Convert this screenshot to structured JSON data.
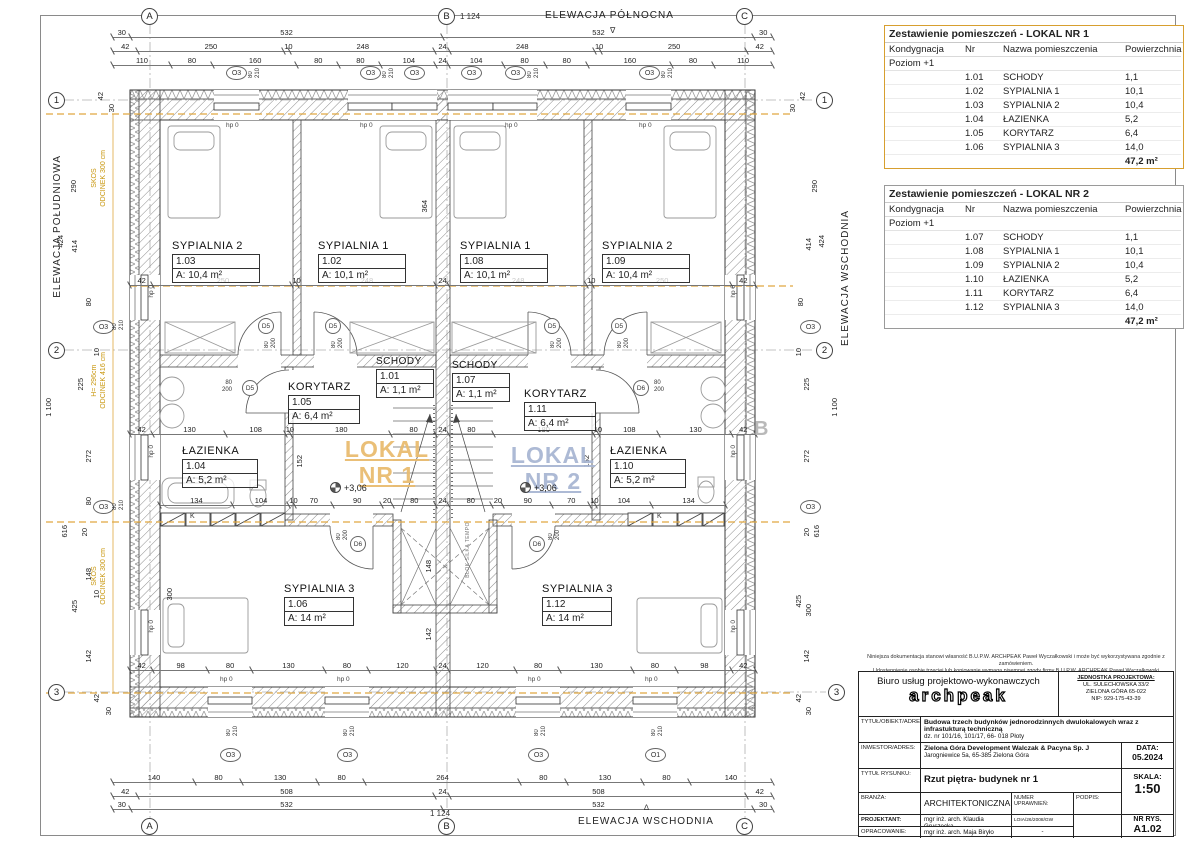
{
  "plan": {
    "title_north": "ELEWACJA PÓŁNOCNA",
    "title_south": "ELEWACJA POŁUDNIOWA",
    "title_east": "ELEWACJA WSCHODNIA",
    "title_bottom": "ELEWACJA WSCHODNIA",
    "overall_w": "1 124",
    "overall_h": "1 100",
    "marker_down": "∇",
    "marker_up": "∆",
    "grid_cols": [
      "A",
      "B",
      "C"
    ],
    "grid_rows": [
      "1",
      "2",
      "3"
    ],
    "rooms": {
      "r103": {
        "name": "SYPIALNIA 2",
        "nr": "1.03",
        "area": "A: 10,4 m²"
      },
      "r102": {
        "name": "SYPIALNIA 1",
        "nr": "1.02",
        "area": "A: 10,1 m²"
      },
      "r108": {
        "name": "SYPIALNIA 1",
        "nr": "1.08",
        "area": "A: 10,1 m²"
      },
      "r109": {
        "name": "SYPIALNIA 2",
        "nr": "1.09",
        "area": "A: 10,4 m²"
      },
      "r105": {
        "name": "KORYTARZ",
        "nr": "1.05",
        "area": "A: 6,4 m²"
      },
      "r101": {
        "name": "SCHODY",
        "nr": "1.01",
        "area": "A: 1,1 m²"
      },
      "r107": {
        "name": "SCHODY",
        "nr": "1.07",
        "area": "A: 1,1 m²"
      },
      "r111": {
        "name": "KORYTARZ",
        "nr": "1.11",
        "area": "A: 6,4 m²"
      },
      "r104": {
        "name": "ŁAZIENKA",
        "nr": "1.04",
        "area": "A: 5,2 m²"
      },
      "r110": {
        "name": "ŁAZIENKA",
        "nr": "1.10",
        "area": "A: 5,2 m²"
      },
      "r106": {
        "name": "SYPIALNIA 3",
        "nr": "1.06",
        "area": "A: 14 m²"
      },
      "r112": {
        "name": "SYPIALNIA 3",
        "nr": "1.12",
        "area": "A: 14 m²"
      }
    },
    "watermarks": {
      "lokal1": "LOKAL\nNR 1",
      "lokal2": "LOKAL\nNR 2",
      "level": "+3,06",
      "section_b": "B",
      "wall_note": "BLOK SILKA TEMPO",
      "k_box": "K"
    },
    "dims": {
      "top1": [
        "30",
        "532",
        "532",
        "30"
      ],
      "top2": [
        "42",
        "250",
        "10",
        "248",
        "24",
        "248",
        "10",
        "250",
        "42"
      ],
      "top3": [
        "110",
        "80",
        "160",
        "80",
        "80",
        "104",
        "24",
        "104",
        "80",
        "80",
        "160",
        "80",
        "110"
      ],
      "bed": [
        "42",
        "250",
        "10",
        "248",
        "24",
        "248",
        "10",
        "250",
        "42"
      ],
      "mid": [
        "42",
        "130",
        "108",
        "10",
        "180",
        "80",
        "24",
        "80",
        "180",
        "10",
        "108",
        "130",
        "42"
      ],
      "bath": [
        "134",
        "104",
        "10",
        "70",
        "90",
        "20",
        "80",
        "24",
        "80",
        "20",
        "90",
        "70",
        "10",
        "104",
        "134"
      ],
      "low": [
        "42",
        "98",
        "80",
        "130",
        "80",
        "120",
        "24",
        "120",
        "80",
        "130",
        "80",
        "98",
        "42"
      ],
      "bottom1": [
        "140",
        "80",
        "130",
        "80",
        "264",
        "80",
        "130",
        "80",
        "140"
      ],
      "bottom2": [
        "42",
        "508",
        "24",
        "508",
        "42"
      ],
      "bottom3": [
        "30",
        "532",
        "532",
        "30"
      ],
      "left": [
        "42",
        "30",
        "290",
        "424",
        "414",
        "80",
        "10",
        "225",
        "1 100",
        "272",
        "80",
        "616",
        "20",
        "148",
        "425",
        "10",
        "142",
        "42",
        "30"
      ],
      "right": [
        "42",
        "30",
        "290",
        "414",
        "424",
        "80",
        "225",
        "10",
        "272",
        "616",
        "20",
        "425",
        "300",
        "142",
        "42",
        "30",
        "1 100"
      ],
      "v364": "364",
      "v152": "152",
      "v300": "300",
      "v148": "148",
      "v142": "142",
      "hp0": "hp 0"
    },
    "openings": {
      "o3": "O3",
      "o1": "O1",
      "o_size": "80\n210",
      "d5": "D5",
      "d6": "D6",
      "d_size": "80\n200"
    },
    "slopes": {
      "s1": "SKOS\nODCINEK 300 cm",
      "s2": "H= 296cm\nODCINEK 416 cm",
      "s3": "SKOS\nODCINEK 300 cm"
    }
  },
  "tables": [
    {
      "title": "Zestawienie pomieszczeń - LOKAL NR 1",
      "col_kond": "Kondygnacja",
      "col_nr": "Nr",
      "col_nazwa": "Nazwa pomieszczenia",
      "col_pow": "Powierzchnia",
      "level": "Poziom +1",
      "rows": [
        [
          "1.01",
          "SCHODY",
          "1,1"
        ],
        [
          "1.02",
          "SYPIALNIA 1",
          "10,1"
        ],
        [
          "1.03",
          "SYPIALNIA 2",
          "10,4"
        ],
        [
          "1.04",
          "ŁAZIENKA",
          "5,2"
        ],
        [
          "1.05",
          "KORYTARZ",
          "6,4"
        ],
        [
          "1.06",
          "SYPIALNIA 3",
          "14,0"
        ]
      ],
      "total": "47,2 m²"
    },
    {
      "title": "Zestawienie pomieszczeń - LOKAL NR 2",
      "col_kond": "Kondygnacja",
      "col_nr": "Nr",
      "col_nazwa": "Nazwa pomieszczenia",
      "col_pow": "Powierzchnia",
      "level": "Poziom +1",
      "rows": [
        [
          "1.07",
          "SCHODY",
          "1,1"
        ],
        [
          "1.08",
          "SYPIALNIA 1",
          "10,1"
        ],
        [
          "1.09",
          "SYPIALNIA 2",
          "10,4"
        ],
        [
          "1.10",
          "ŁAZIENKA",
          "5,2"
        ],
        [
          "1.11",
          "KORYTARZ",
          "6,4"
        ],
        [
          "1.12",
          "SYPIALNIA 3",
          "14,0"
        ]
      ],
      "total": "47,2 m²"
    }
  ],
  "titleblock": {
    "disclaimer1": "Niniejsza dokumentacja stanowi własność B.U.P.W. ARCHPEAK Paweł Wyczałkowski i może być wykorzystywana zgodnie z zamówieniem.",
    "disclaimer2": "Udostępnienie osobie trzeciej lub kopiowanie wymaga pisemnej zgody firmy B.U.P.W. ARCHPEAK Paweł Wyczałkowski",
    "office_line": "Biuro usług projektowo-wykonawczych",
    "logo": "archpeak",
    "unit_label": "JEDNOSTKA PROJEKTOWA:",
    "unit_addr1": "UL. SULECHOWSKA 33/2",
    "unit_addr2": "ZIELONA GÓRA 65-022",
    "unit_nip": "NIP: 929-175-43-39",
    "obj_label": "TYTUŁ/OBIEKT/ADRES:",
    "obj_value": "Budowa trzech budynków jednorodzinnych dwulokalowych wraz z infrastukturą techniczną",
    "obj_value2": "dz. nr 101/16, 101/17, 66- 018 Płoty",
    "inv_label": "INWESTOR/ADRES:",
    "inv_value": "Zielona Góra Development Walczak & Pacyna Sp. J",
    "inv_value2": "Jarogniewice 5a, 65-385 Zielona Góra",
    "draw_label": "TYTUŁ RYSUNKU:",
    "draw_value": "Rzut piętra- budynek nr 1",
    "branch_label": "BRANŻA:",
    "branch_value": "ARCHITEKTONICZNA",
    "numer_label": "NUMER\nUPRAWNIEŃ:",
    "podpis_label": "PODPIS:",
    "proj_label": "PROJEKTANT:",
    "proj_value": "mgr inż. arch. Klaudia Gruszecka",
    "proj_value2": "UPRAWNIENIA W SPECJ. ARCHITEKTONICZNEJ",
    "proj_numer": "LOIA/26/2008/GW",
    "opr_label": "OPRACOWANIE:",
    "opr_value": "mgr inż. arch. Maja Biryło",
    "opr_numer": "-",
    "data_label": "DATA:",
    "data_value": "05.2024",
    "skala_label": "SKALA:",
    "skala_value": "1:50",
    "nr_label": "NR RYS.",
    "nr_value": "A1.02"
  }
}
